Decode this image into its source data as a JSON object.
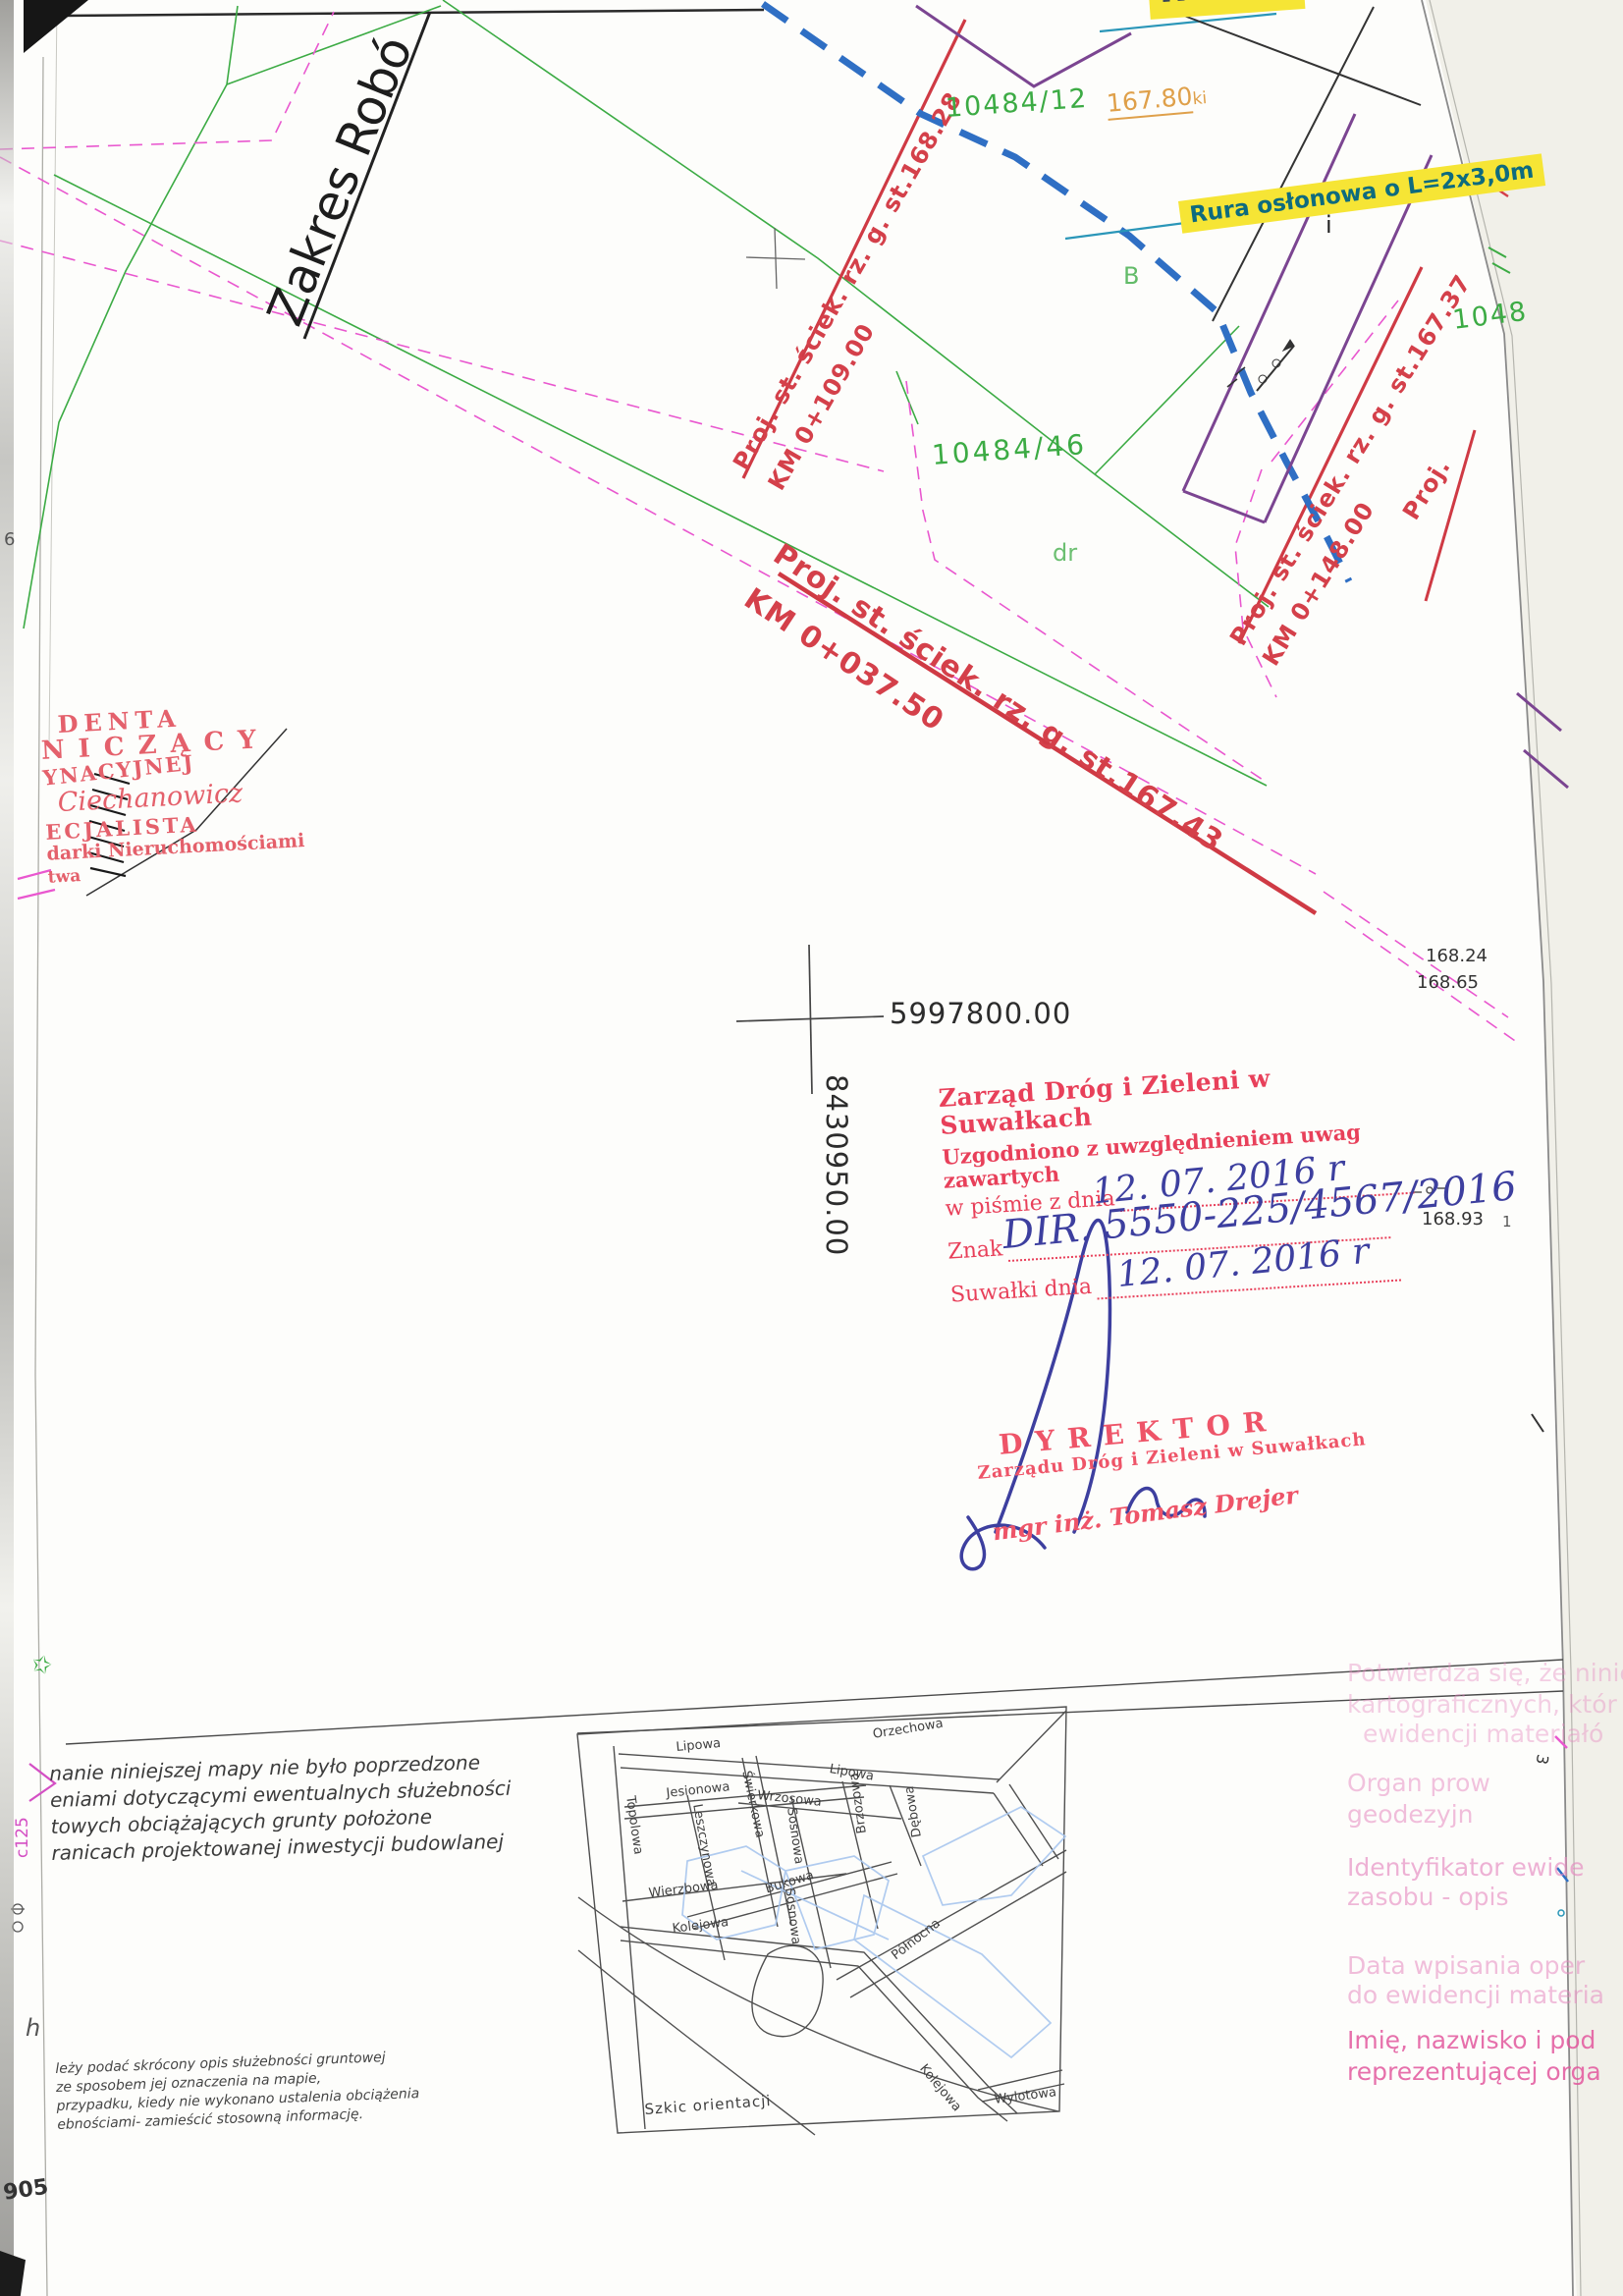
{
  "map": {
    "work_extent_label": "Zakres Robó",
    "parcels": {
      "p1": "10484/12",
      "p2": "10484/46",
      "p3": "1048"
    },
    "land_use": "dr",
    "letters": {
      "b": "B",
      "i": "i"
    },
    "project_labels": [
      {
        "line1": "Proj. st. ściek. rz. g. st.168.28",
        "line2": "KM 0+109.00"
      },
      {
        "line1": "Proj. st. ściek. rz. g. st.167.43",
        "line2": "KM 0+037.50"
      },
      {
        "line1": "Proj. st. ściek. rz. g. st.167.37",
        "line2": "KM 0+148.00"
      },
      {
        "line1": "Proj."
      }
    ],
    "pipe_callout": "Rura osłonowa o L=2x3,0m",
    "grid_cross": {
      "northing": "5997800.00",
      "easting": "8430950.00"
    },
    "elevations": {
      "top": "167.80",
      "top_suffix": "ki",
      "right_upper": "168.24",
      "right_lower": "168.65",
      "right_bottom": "168.93",
      "right_bottom_suffix": "1"
    }
  },
  "stamps": {
    "approval": {
      "title": "Zarząd Dróg i Zieleni w Suwałkach",
      "subtitle": "Uzgodniono z uwzględnieniem uwag zawartych",
      "field1_label": "w piśmie z dnia",
      "field1_value": "12. 07. 2016 r",
      "field2_label": "Znak",
      "field2_value": "DIR. 5550-225/4567/2016",
      "field3_label": "Suwałki dnia",
      "field3_value": "12. 07. 2016 r"
    },
    "director": {
      "title": "DYREKTOR",
      "org": "Zarządu Dróg i Zieleni w Suwałkach",
      "name": "mgr inż. Tomasz Drejer"
    },
    "left_partial": {
      "lines": [
        "DENTA",
        "NICZĄCY",
        "YNACYJNEJ",
        "Ciechanowicz",
        "ECJALISTA",
        "darki Nieruchomościami",
        "twa"
      ]
    }
  },
  "notes": {
    "disclaimer": [
      "nanie niniejszej mapy nie było poprzedzone",
      "eniami dotyczącymi ewentualnych służebności",
      "towych obciążających grunty położone",
      "ranicach projektowanej inwestycji budowlanej"
    ],
    "footnote": [
      "leży podać skrócony opis służebności gruntowej",
      "ze sposobem jej oznaczenia na mapie,",
      "przypadku, kiedy nie wykonano ustalenia obciążenia",
      "ebnościami- zamieścić stosowną informację."
    ]
  },
  "inset": {
    "title": "Szkic orientacji",
    "streets": [
      "Lipowa",
      "Orzechowa",
      "Lipowa",
      "Jesionowa",
      "Wrzosowa",
      "Topolowa",
      "Leszczynowa",
      "Świerkowa",
      "Sosnowa",
      "Brzozowa",
      "Dębowa",
      "Wierzbowa",
      "Bukowa",
      "Sosnowa",
      "Kolejowa",
      "Północna",
      "Kolejowa",
      "Wylotowa"
    ]
  },
  "side_column": {
    "groups": [
      [
        "Potwierdza się, że ninie",
        "kartograficznych, któr",
        "ewidencji materiałó"
      ],
      [
        "Organ prow",
        "geodezyjn"
      ],
      [
        "Identyfikator ewide",
        "zasobu - opis"
      ],
      [
        "Data wpisania oper",
        "do ewidencji materia"
      ],
      [
        "Imię, nazwisko i pod",
        "reprezentującej orga"
      ]
    ]
  },
  "margin": {
    "bottom_left_number": "905",
    "left_digit": "6",
    "left_letter": "h",
    "left_code": "c125",
    "edge_digit": "3",
    "star": "✩"
  },
  "colors": {
    "parcel_green": "#3cab44",
    "project_red": "#d4404a",
    "dashed_magenta": "#e957cf",
    "pipe_blue": "#2f6fc4",
    "building_purple": "#7b4591",
    "teal_line": "#2a96b8",
    "highlight_yellow": "#f6e535",
    "stamp_red": "#e8405a",
    "ink_blue": "#3d3f9f",
    "faded_pink": "#e689c0",
    "elevation_orange": "#dfa04a"
  }
}
